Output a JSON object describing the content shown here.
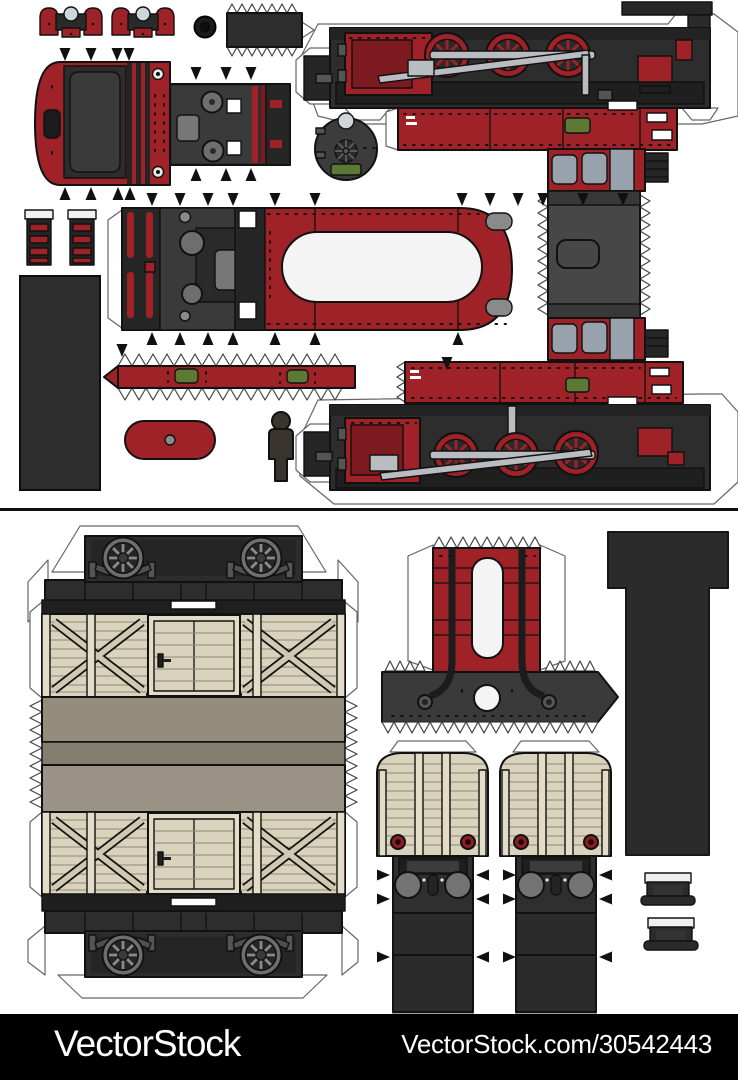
{
  "page": {
    "background": "#ffffff",
    "description": "Paper model cut-out sheet of a vintage red tank locomotive (top half) and a wooden freight wagon (bottom half)"
  },
  "watermark": {
    "brand": "VectorStock",
    "site_ref": "VectorStock.com/30542443",
    "bar_color": "#000000",
    "text_color": "#ffffff"
  },
  "palette": {
    "red": "#9e2227",
    "dark_red": "#7c1a1f",
    "black_part": "#2b2b2b",
    "chassis_grey": "#2d2d2d",
    "steel_grey": "#b9bdc1",
    "window_grey": "#97a2ac",
    "plate_green": "#5c7a33",
    "wagon_beige": "#d9d3bd",
    "roof_taupe": "#948c7d",
    "cut_line": "#666666",
    "white": "#ffffff"
  },
  "sheet_top": {
    "parts": [
      "front-buffer-cluster-left",
      "front-buffer-cluster-right",
      "chimney-cap-disc",
      "glue-tab-plate",
      "smokebox-door-wrap",
      "boiler-top-panel",
      "smokebox-front-disc",
      "locomotive-side-view-right",
      "cab-front-and-roof-strip",
      "boiler-band-right",
      "boiler-band-left",
      "locomotive-side-view-left",
      "boiler-barrel-wrap",
      "cab-step-ladders",
      "coal-bunker-panel",
      "running-board-strip",
      "roof-capsule",
      "scale-figure"
    ]
  },
  "sheet_bottom": {
    "parts": [
      "wagon-side-and-roof-wrap",
      "wagon-underframe-top",
      "wagon-underframe-bottom",
      "firebox-wrap",
      "smokebox-saddle-apron",
      "underframe-floor-t-piece",
      "wagon-end-left",
      "wagon-end-right",
      "axlebox-part-upper",
      "axlebox-part-lower"
    ]
  }
}
